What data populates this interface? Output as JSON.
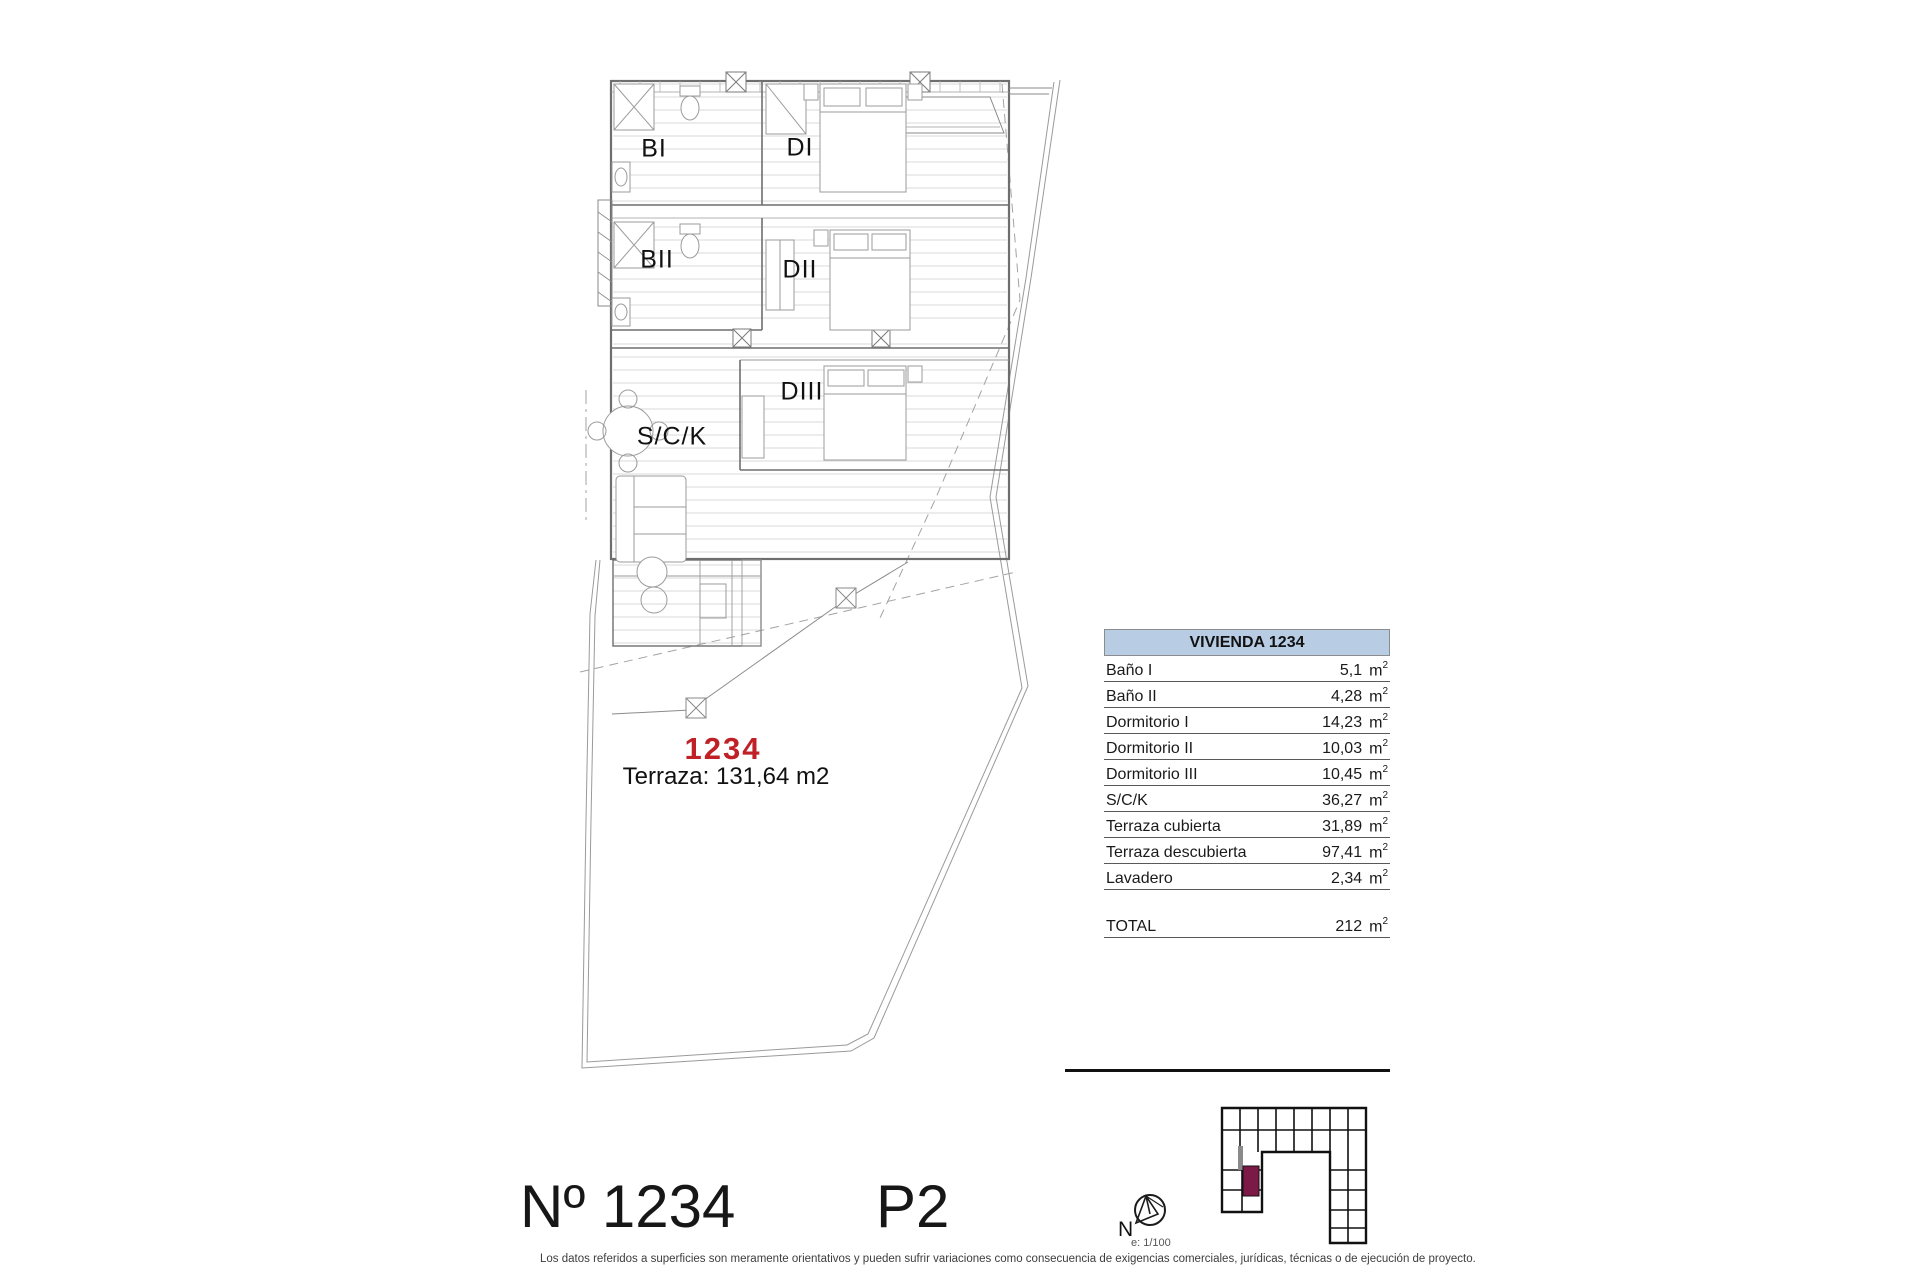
{
  "plan": {
    "unit_number_red": "1234",
    "terrace_note": "Terraza: 131,64 m2",
    "rooms": [
      {
        "label": "BI"
      },
      {
        "label": "DI"
      },
      {
        "label": "BII"
      },
      {
        "label": "DII"
      },
      {
        "label": "DIII"
      },
      {
        "label": "S/C/K"
      }
    ]
  },
  "surface_table": {
    "title": "VIVIENDA 1234",
    "header_bg": "#b8cce4",
    "units": {
      "base": "m",
      "sup": "2"
    },
    "rows": [
      {
        "label": "Baño I",
        "value": "5,1"
      },
      {
        "label": "Baño II",
        "value": "4,28"
      },
      {
        "label": "Dormitorio I",
        "value": "14,23"
      },
      {
        "label": "Dormitorio II",
        "value": "10,03"
      },
      {
        "label": "Dormitorio III",
        "value": "10,45"
      },
      {
        "label": "S/C/K",
        "value": "36,27"
      },
      {
        "label": "Terraza cubierta",
        "value": "31,89"
      },
      {
        "label": "Terraza descubierta",
        "value": "97,41"
      },
      {
        "label": "Lavadero",
        "value": "2,34"
      }
    ],
    "total": {
      "label": "TOTAL",
      "value": "212"
    }
  },
  "footer": {
    "unit_title": "Nº 1234",
    "floor_title": "P2",
    "disclaimer": "Los datos referidos a superficies son meramente orientativos y pueden sufrir variaciones como consecuencia de exigencias comerciales, jurídicas, técnicas o de ejecución de proyecto."
  },
  "compass": {
    "north_label": "N",
    "scale_label": "e: 1/100"
  },
  "key_plan": {
    "highlight_color": "#7d1947"
  },
  "colors": {
    "accent_red": "#bf2126",
    "table_header_blue": "#b8cce4",
    "keyplan_highlight": "#7d1947",
    "plan_line_gray": "#6e6e6e"
  }
}
